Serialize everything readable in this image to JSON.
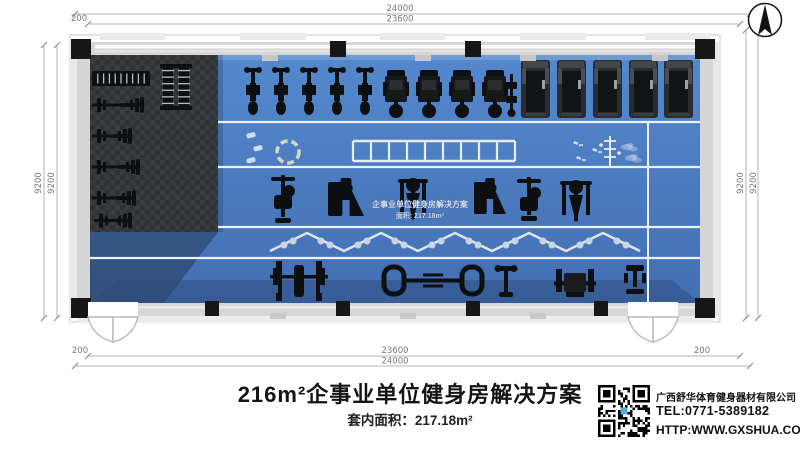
{
  "colors": {
    "floor_blue": "#4a7dc4",
    "floor_blue_light": "#5488cd",
    "floor_dark_a": "#303336",
    "floor_dark_b": "#3a3d40",
    "wall_gray": "#d6d6d6",
    "wall_light": "#eaeaea",
    "column_black": "#161616",
    "equipment_black": "#0e0f11",
    "lane_white": "#eef2f7",
    "marking_white": "#e8edf3",
    "zigzag_dot": "#ccd4de",
    "ring_khaki": "#d6d8ba",
    "dim_line": "#b3b3b3",
    "qr_blue": "#54aede"
  },
  "dims": {
    "top_outer": "24000",
    "top_inner": "23600",
    "bottom_inner": "23600",
    "bottom_outer": "24000",
    "left_outer": "9200",
    "left_inner": "9200",
    "right_inner": "9200",
    "right_outer": "9200",
    "off_top_left": "200",
    "off_bottom_left": "200",
    "off_bottom_right": "200"
  },
  "watermark": {
    "line1": "企事业单位健身房解决方案",
    "line2": "面积: 217.18m²"
  },
  "footer": {
    "title": "216m²企事业单位健身房解决方案",
    "subtitle": "套内面积：217.18m²",
    "company_name": "广西舒华体育健身器材有限公司",
    "company_tel": "TEL:0771-5389182",
    "company_web": "HTTP:WWW.GXSHUA.COM"
  },
  "icons": {
    "north_compass": "north-arrow",
    "qr_code": "qr-code"
  },
  "equipment": [
    {
      "t": "rack-h",
      "x": 92,
      "y": 71,
      "w": 58,
      "h": 15
    },
    {
      "t": "rack-v",
      "x": 162,
      "y": 64,
      "w": 12,
      "h": 46
    },
    {
      "t": "rack-v",
      "x": 178,
      "y": 64,
      "w": 12,
      "h": 46
    },
    {
      "t": "bench",
      "x": 92,
      "y": 96,
      "w": 52,
      "h": 18
    },
    {
      "t": "bench",
      "x": 92,
      "y": 128,
      "w": 40,
      "h": 16
    },
    {
      "t": "bench",
      "x": 92,
      "y": 158,
      "w": 48,
      "h": 18
    },
    {
      "t": "bench",
      "x": 92,
      "y": 190,
      "w": 44,
      "h": 16
    },
    {
      "t": "bench",
      "x": 94,
      "y": 213,
      "w": 38,
      "h": 15
    },
    {
      "t": "bike",
      "x": 245,
      "y": 68,
      "w": 16,
      "h": 48
    },
    {
      "t": "bike",
      "x": 273,
      "y": 68,
      "w": 16,
      "h": 48
    },
    {
      "t": "bike",
      "x": 301,
      "y": 68,
      "w": 16,
      "h": 48
    },
    {
      "t": "bike",
      "x": 329,
      "y": 68,
      "w": 16,
      "h": 48
    },
    {
      "t": "bike",
      "x": 357,
      "y": 68,
      "w": 16,
      "h": 48
    },
    {
      "t": "tower",
      "x": 385,
      "y": 70,
      "w": 22,
      "h": 48
    },
    {
      "t": "tower",
      "x": 418,
      "y": 70,
      "w": 22,
      "h": 48
    },
    {
      "t": "tower",
      "x": 451,
      "y": 70,
      "w": 22,
      "h": 48
    },
    {
      "t": "tower",
      "x": 484,
      "y": 70,
      "w": 22,
      "h": 48
    },
    {
      "t": "stepper",
      "x": 507,
      "y": 74,
      "w": 9,
      "h": 42
    },
    {
      "t": "treadmill",
      "x": 521,
      "y": 60,
      "w": 29,
      "h": 58
    },
    {
      "t": "treadmill",
      "x": 557,
      "y": 60,
      "w": 29,
      "h": 58
    },
    {
      "t": "treadmill",
      "x": 593,
      "y": 60,
      "w": 29,
      "h": 58
    },
    {
      "t": "treadmill",
      "x": 629,
      "y": 60,
      "w": 29,
      "h": 58
    },
    {
      "t": "treadmill",
      "x": 664,
      "y": 60,
      "w": 29,
      "h": 58
    },
    {
      "t": "mat",
      "x": 246,
      "y": 134
    },
    {
      "t": "mat",
      "x": 253,
      "y": 147
    },
    {
      "t": "mat",
      "x": 246,
      "y": 159
    },
    {
      "t": "ring",
      "x": 288,
      "y": 152,
      "r": 11
    },
    {
      "t": "ladder",
      "x": 353,
      "y": 140,
      "w": 162,
      "h": 21,
      "rungs": 9
    },
    {
      "t": "pole",
      "x": 610,
      "y": 136,
      "h": 32
    },
    {
      "t": "scatter",
      "x": 574,
      "y": 141
    },
    {
      "t": "scatter",
      "x": 577,
      "y": 156
    },
    {
      "t": "scatter",
      "x": 593,
      "y": 148
    },
    {
      "t": "cloud",
      "x": 627,
      "y": 147
    },
    {
      "t": "cloud",
      "x": 631,
      "y": 158
    },
    {
      "t": "m-cable",
      "x": 266,
      "y": 175,
      "w": 34,
      "h": 50
    },
    {
      "t": "m-box",
      "x": 328,
      "y": 178,
      "w": 36,
      "h": 44
    },
    {
      "t": "m-round",
      "x": 396,
      "y": 175,
      "w": 34,
      "h": 46
    },
    {
      "t": "m-box",
      "x": 474,
      "y": 178,
      "w": 32,
      "h": 42
    },
    {
      "t": "m-cable",
      "x": 512,
      "y": 177,
      "w": 34,
      "h": 46
    },
    {
      "t": "m-round",
      "x": 558,
      "y": 177,
      "w": 36,
      "h": 46
    },
    {
      "t": "power-rack",
      "x": 276,
      "y": 261,
      "w": 46,
      "h": 40
    },
    {
      "t": "rig",
      "x": 384,
      "y": 267,
      "w": 98,
      "h": 27
    },
    {
      "t": "t-bench",
      "x": 496,
      "y": 266,
      "w": 20,
      "h": 32
    },
    {
      "t": "m-plate",
      "x": 554,
      "y": 269,
      "w": 42,
      "h": 29
    },
    {
      "t": "tower2",
      "x": 624,
      "y": 265,
      "w": 22,
      "h": 30
    }
  ]
}
